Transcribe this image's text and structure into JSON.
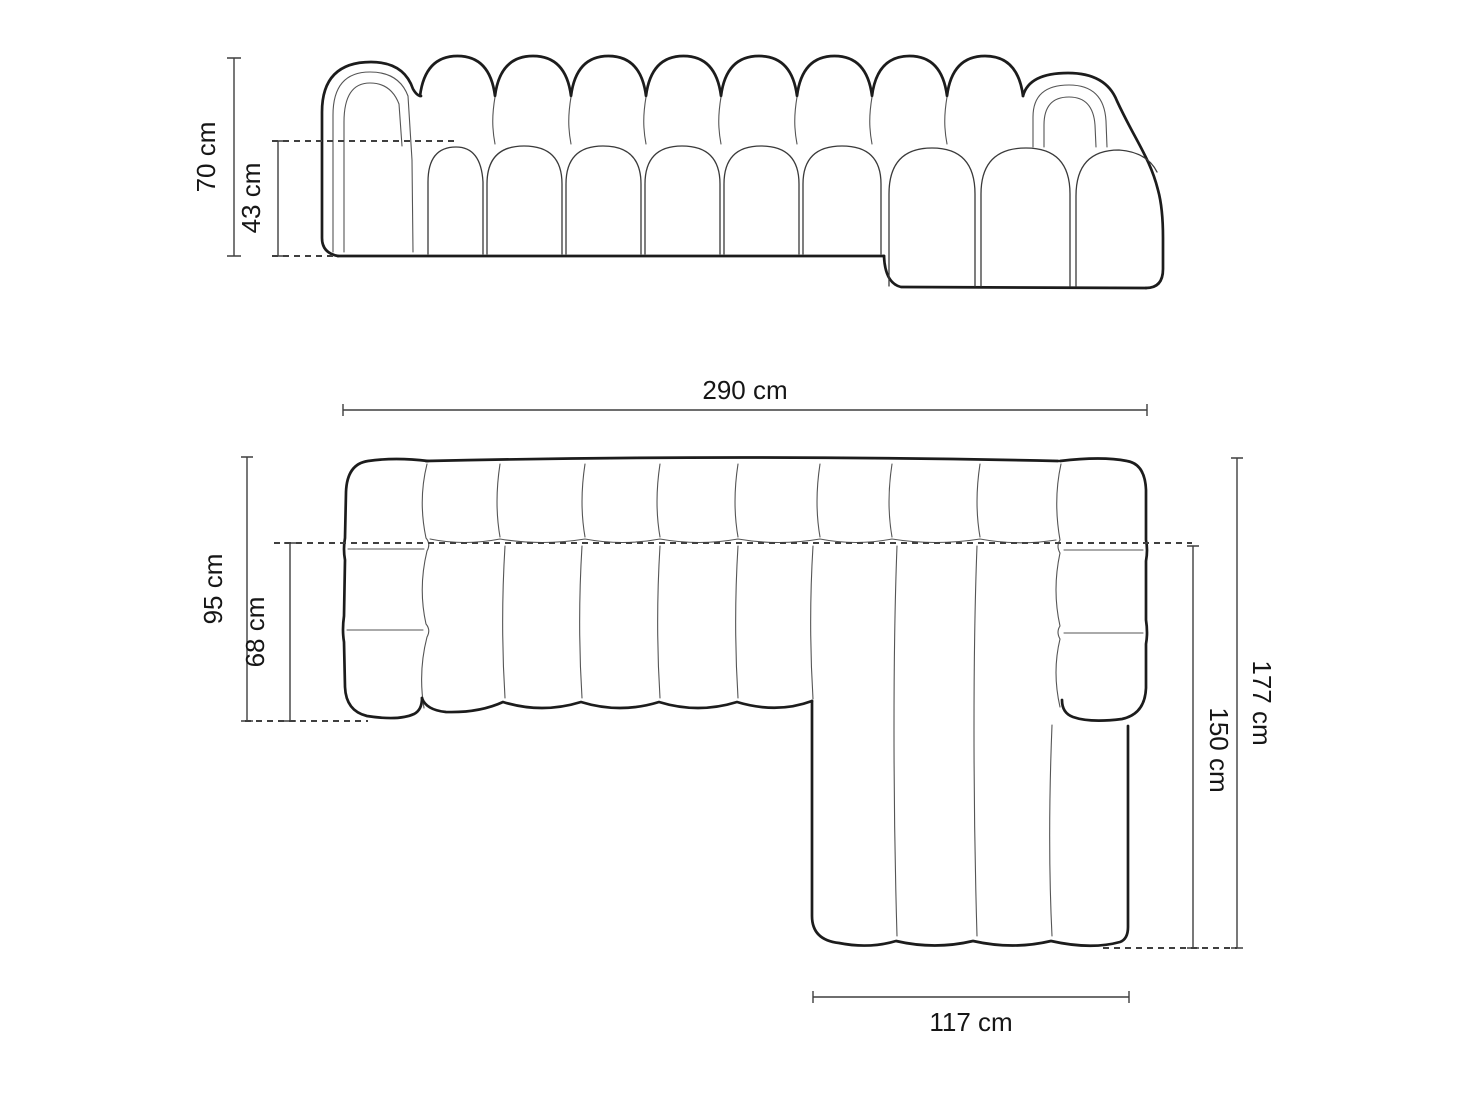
{
  "figure": {
    "kind": "sofa-dimension-drawing",
    "views": [
      "front-elevation",
      "top-plan"
    ]
  },
  "views": {
    "front": {
      "dims": {
        "total_height": "70 cm",
        "seat_height": "43 cm"
      }
    },
    "plan": {
      "dims": {
        "total_width": "290 cm",
        "side_depth": "95 cm",
        "seat_depth": "68 cm",
        "total_depth": "177 cm",
        "chaise_depth": "150 cm",
        "chaise_width": "117 cm"
      }
    }
  },
  "colors": {
    "outline": "#1c1c1c",
    "seam": "#555555",
    "med": "#3a3a3a",
    "dim": "#3f3f3f",
    "text": "#161616",
    "bg": "#ffffff"
  }
}
